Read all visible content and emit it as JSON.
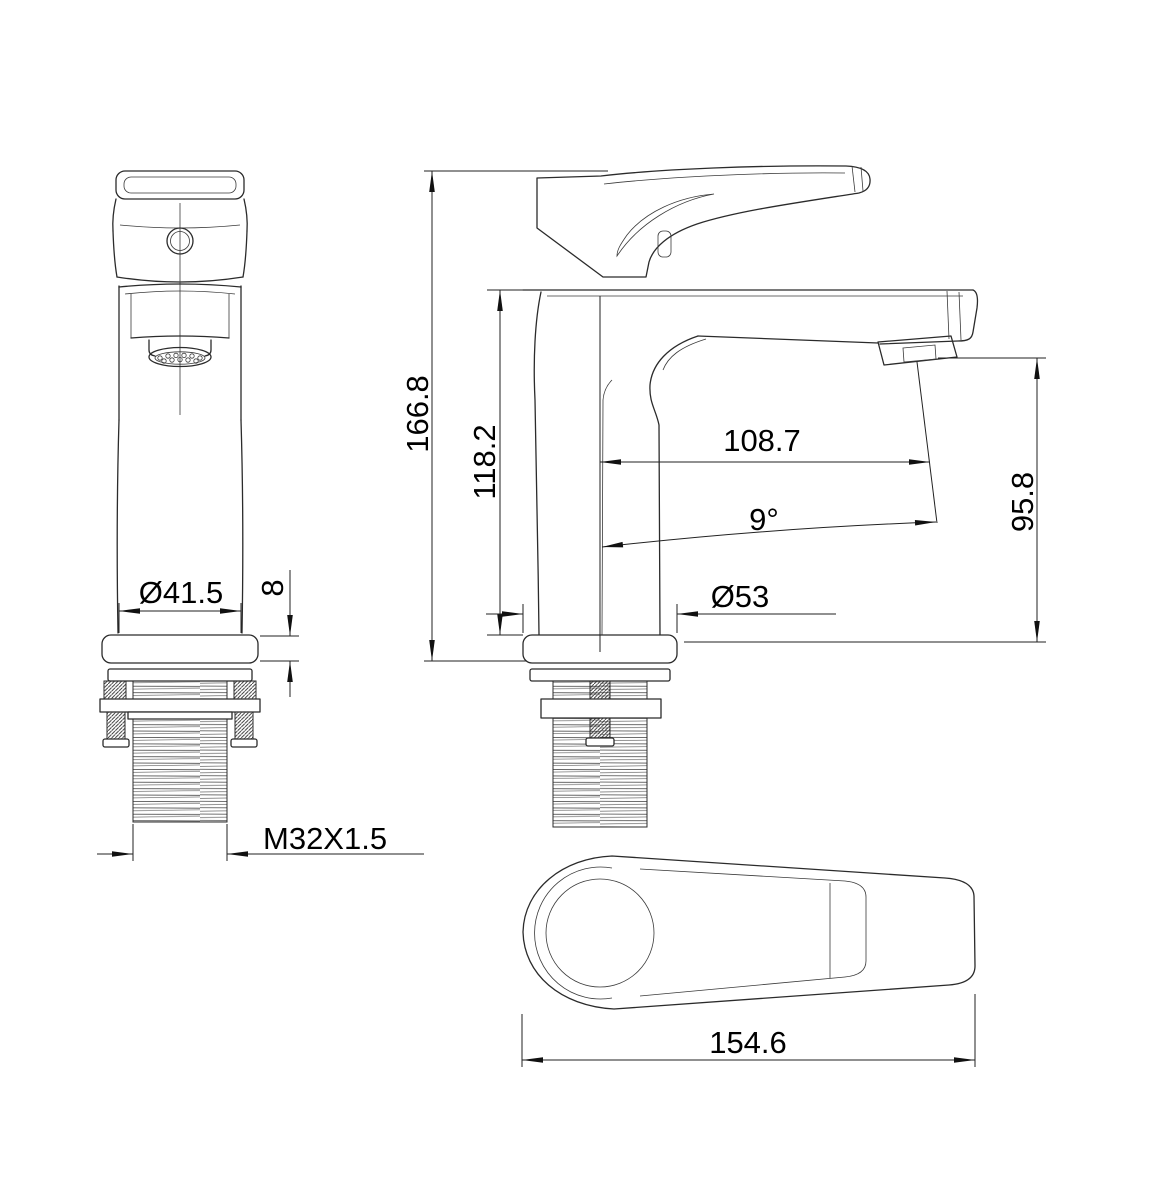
{
  "page": {
    "background": "#ffffff",
    "line_color": "#2b2b2b",
    "text_color": "#000000"
  },
  "views": {
    "front": {
      "dimensions": {
        "body_diameter": "Ø41.5",
        "flange_thickness": "8",
        "thread_spec": "M32X1.5"
      }
    },
    "side": {
      "dimensions": {
        "overall_height": "166.8",
        "spout_height": "118.2",
        "spout_reach": "108.7",
        "spout_angle": "9°",
        "outlet_height": "95.8",
        "flange_diameter": "Ø53"
      }
    },
    "top": {
      "dimensions": {
        "handle_length": "154.6"
      }
    }
  }
}
